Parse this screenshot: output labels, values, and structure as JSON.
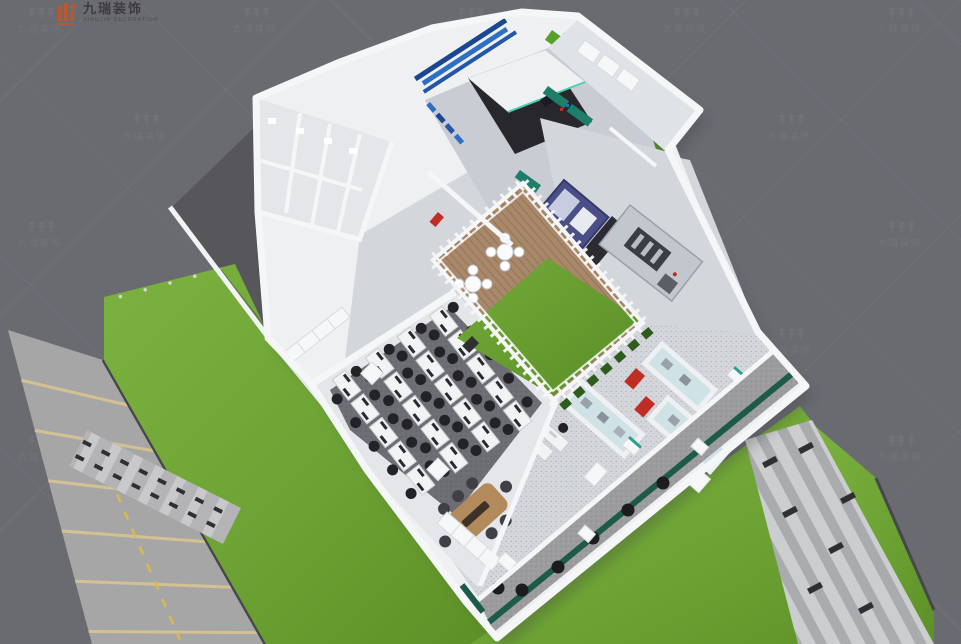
{
  "window": {
    "width": 961,
    "height": 644,
    "kind": "3D isometric office floor-plan rendering"
  },
  "logo": {
    "brand_cn": "九瑞装饰",
    "brand_en": "XINGJIN DECORATION",
    "icon_color": "#c0572b"
  },
  "watermark": {
    "stamp_icon": "↟↟↟",
    "stamp_cn": "九瑞装饰"
  },
  "palette": {
    "background": "#6a6a71",
    "road": "#a6a6a7",
    "road_line": "#d3c191",
    "road_yellow": "#d9b94d",
    "pavement_dark": "#56565b",
    "curb": "#47474b",
    "grass_light": "#7cb23f",
    "grass": "#6da334",
    "grass_dark": "#5d9027",
    "wall": "#f5f6f8",
    "wall_shade": "#d9dbdf",
    "fence": "#f2f3f5",
    "floor": "#d3d6da",
    "floor_light": "#e4e6e9",
    "floor_hall": "#c9cdd3",
    "floor_room": "#dfe2e6",
    "carpet": "#6d6d74",
    "carpet_dot": "#5a5a60",
    "speckle_base": "#9c9c9f",
    "speckle_dot": "#86868a",
    "deck": "#a9886a",
    "deck_line": "#8d6f55",
    "cgrass_light": "#74aa38",
    "cgrass_dark": "#5a8e28",
    "hedge": "#4f8326",
    "hedge_bright": "#58a02c",
    "shrub": "#2f5c1e",
    "bench_green": "#1d5a49",
    "blue1": "#2e6fc4",
    "blue2": "#2456a8",
    "blue3": "#1b4690",
    "machine_dark": "#28282c",
    "machine_teal": "#49d0b5",
    "navy": "#4b4f88",
    "navy_dark": "#34386b",
    "navy_light": "#c8cce0",
    "lathe": "#c2c7ce",
    "lathe_dark": "#3a3d44",
    "red": "#bf2d24",
    "teal": "#2aa08e",
    "wood": "#b28a5c",
    "wood_dark": "#3c3228",
    "chair": "#232327",
    "chair_gray": "#3f3f45",
    "desk": "#f2f3f5",
    "desk_stroke": "#c9ccd1",
    "mon": "#2a2a2e",
    "glass": "#cfe2e6",
    "ped_white": "#f6f7f9",
    "walk_light": "#cbcdcf",
    "walk_mid": "#a9abae",
    "walk_dark": "#2f2f33",
    "cross_base": "#b4b4b6",
    "cross_light": "#c9c9cb",
    "shadow": "#3a3a40"
  },
  "scene": {
    "view": "isometric top-down",
    "site": {
      "parking_lines": 6,
      "crosswalk_stripes": 7,
      "crosswalk_dashes": 8,
      "walkway_dashes": 7,
      "lawns": 4,
      "bollards": 5
    },
    "building": {
      "areas": [
        "exhibition-hall",
        "machine-room",
        "restrooms-wing",
        "central-courtyard",
        "open-office",
        "product-showroom",
        "entry-terrace"
      ],
      "courtyard": {
        "table_sets": 2,
        "chairs_per_table": 4,
        "deck": "wood",
        "lawn": true
      },
      "office": {
        "desk_banks": 4,
        "desks_per_bank": 5,
        "meeting_table_chairs": 8
      },
      "showroom": {
        "display_cases": 3,
        "red_stands": 2,
        "pedestals": 4
      },
      "machines": [
        "cnc-machining-center",
        "navy-control-cabinet",
        "lathe"
      ],
      "terrace": {
        "stools": 6,
        "green_bench": true,
        "planters": 3
      }
    }
  }
}
